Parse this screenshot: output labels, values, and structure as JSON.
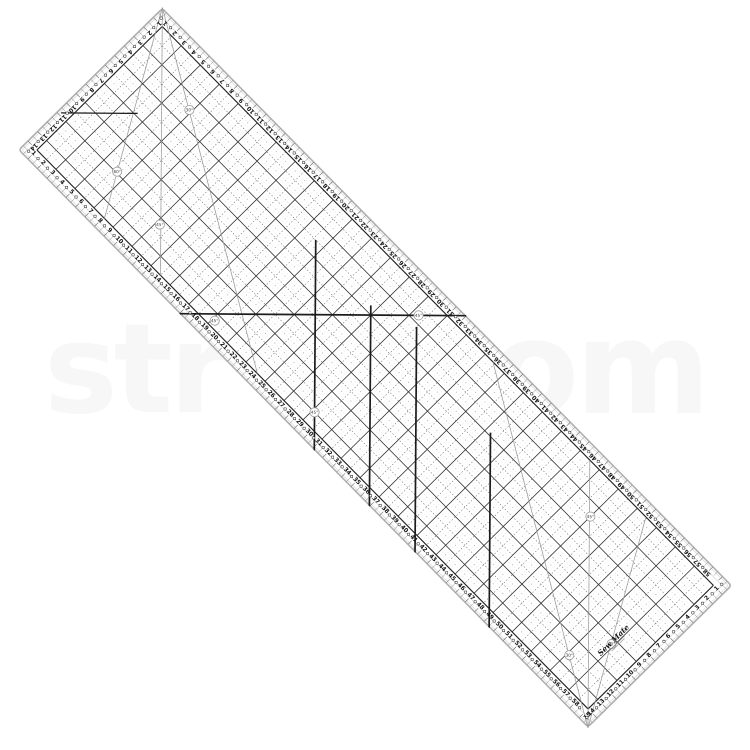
{
  "watermark": {
    "left_fragment": "str",
    "right_fragment": "om",
    "color": "#f7f7f7"
  },
  "ruler": {
    "brand": "Sew Mate",
    "shape": {
      "length_cm": 60,
      "width_cm": 15,
      "px_per_cm": 13.55,
      "rotation_deg": 45.4,
      "origin_x": 162,
      "origin_y": 7
    },
    "colors": {
      "face": "#ffffff",
      "rim_outer": "#b0b0b0",
      "rim_inner": "#dcdcdc",
      "grid_solid": "#333333",
      "grid_border": "#222222",
      "grid_dash": "#666666",
      "speckle": "#8a8a8a",
      "bias_line": "#1c1c1c",
      "angle_line": "#9a9a9a",
      "number": "#111111",
      "tick": "#555555",
      "margin_line": "#999999"
    },
    "edge_numbers": {
      "top": {
        "from": 1,
        "to": 58
      },
      "bottom": {
        "from": 1,
        "to": 58
      },
      "left": {
        "from": 1,
        "to": 14
      },
      "right": {
        "from": 1,
        "to": 15
      }
    },
    "grid": {
      "x_from_cm": 1,
      "x_to_cm": 59,
      "y_from_cm": 1,
      "y_to_cm": 14,
      "solid_every_cm": 2,
      "dashed_every_cm": 1,
      "speckle_every_cm": 0.5
    },
    "angle_circles": [
      {
        "label": "30°",
        "x": 6.8,
        "y": 3.9
      },
      {
        "label": "60°",
        "x": 6.3,
        "y": 10.9
      },
      {
        "label": "45°",
        "x": 11.3,
        "y": 11.4
      },
      {
        "label": "45°",
        "x": 19.2,
        "y": 13.5
      },
      {
        "label": "45°",
        "x": 29.5,
        "y": 2.5
      },
      {
        "label": "45°",
        "x": 29.2,
        "y": 13.0
      },
      {
        "label": "45°",
        "x": 49.0,
        "y": 3.9
      },
      {
        "label": "60°",
        "x": 56.8,
        "y": 9.4
      },
      {
        "label": "30°",
        "x": 55.2,
        "y": 12.2
      }
    ],
    "angle_fan_lines": [
      {
        "x1": 0,
        "y1": 0,
        "x2": 24.2,
        "y2": 14
      },
      {
        "x1": 0,
        "y1": 0,
        "x2": 14,
        "y2": 14
      },
      {
        "x1": 0,
        "y1": 0,
        "x2": 8.1,
        "y2": 14
      },
      {
        "x1": 60,
        "y1": 15,
        "x2": 35.8,
        "y2": 1
      },
      {
        "x1": 60,
        "y1": 15,
        "x2": 46,
        "y2": 1
      },
      {
        "x1": 60,
        "y1": 15,
        "x2": 51.9,
        "y2": 1
      }
    ],
    "bias_lines": [
      {
        "x1": 0.3,
        "y1": 10.8,
        "x2": 4.3,
        "y2": 6.8,
        "w": 1.3
      },
      {
        "x1": 17,
        "y1": 15,
        "x2": 32,
        "y2": 0,
        "w": 1.7
      },
      {
        "x1": 20.2,
        "y1": 4,
        "x2": 31.2,
        "y2": 15,
        "w": 1.7
      },
      {
        "x1": 26.5,
        "y1": 4.5,
        "x2": 37,
        "y2": 15,
        "w": 1.7
      },
      {
        "x1": 30,
        "y1": 3.2,
        "x2": 41.8,
        "y2": 15,
        "w": 1.7
      },
      {
        "x1": 39.4,
        "y1": 4.8,
        "x2": 49.6,
        "y2": 15,
        "w": 1.7
      }
    ],
    "logo": {
      "x_cm": 56.7,
      "y_cm": 9.1,
      "rotation_deg": -90
    }
  }
}
